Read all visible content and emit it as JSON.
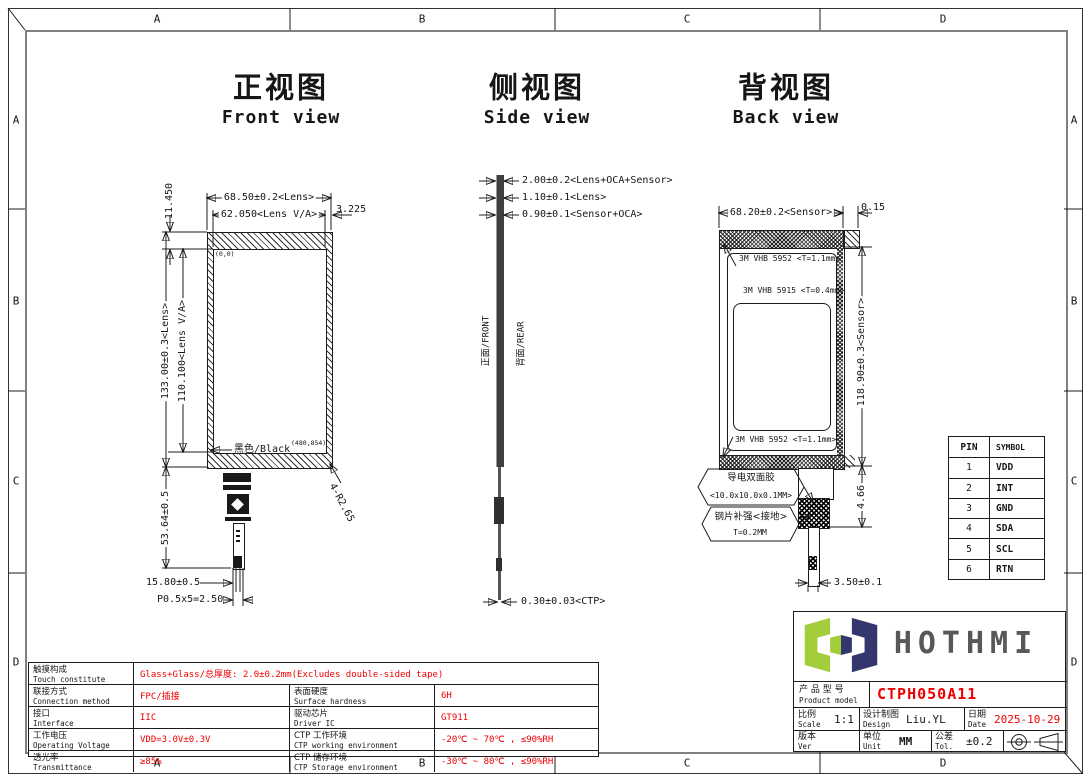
{
  "border": {
    "cols": [
      "A",
      "B",
      "C",
      "D"
    ],
    "rows": [
      "A",
      "B",
      "C",
      "D"
    ]
  },
  "views": {
    "front": {
      "title_cn": "正视图",
      "title_en": "Front view",
      "dim_lens_w": "68.50±0.2<Lens>",
      "dim_va_w": "62.050<Lens V/A>",
      "dim_side_margin": "3.225",
      "dim_top_margin": "11.450",
      "dim_lens_h": "133.00±0.3<Lens>",
      "dim_va_h": "110.100<Lens V/A>",
      "label_black": "黑色/Black",
      "label_origin": "(0,0)",
      "label_resolution": "(480,854)",
      "dim_corner_radius": "4-R2.65",
      "dim_fpc_length": "53.64±0.5",
      "dim_fpc_offset": "15.80±0.5",
      "dim_fpc_pitch": "P0.5x5=2.50"
    },
    "side": {
      "title_cn": "侧视图",
      "title_en": "Side view",
      "dim_total": "2.00±0.2<Lens+OCA+Sensor>",
      "dim_lens": "1.10±0.1<Lens>",
      "dim_sensor_oca": "0.90±0.1<Sensor+OCA>",
      "label_front_face": "正面/FRONT",
      "label_rear_face": "背面/REAR",
      "dim_ctp": "0.30±0.03<CTP>"
    },
    "back": {
      "title_cn": "背视图",
      "title_en": "Back view",
      "dim_sensor_w": "68.20±0.2<Sensor>",
      "dim_edge_offset": "0.15",
      "tape_top": "3M VHB 5952 <T=1.1mm>",
      "tape_inner": "3M VHB 5915 <T=0.4mm>",
      "tape_bottom": "3M VHB 5952 <T=1.1mm>",
      "dim_sensor_h": "118.90±0.3<Sensor>",
      "label_cond_tape": "导电双面胶",
      "label_cond_tape_size": "<10.0x10.0x0.1MM>",
      "label_steel": "钢片补强<接地>",
      "label_steel_thickness": "T=0.2MM",
      "dim_tail_gap": "4.66",
      "dim_fpc_width": "3.50±0.1"
    }
  },
  "pin_table": {
    "headers": [
      "PIN",
      "SYMBOL"
    ],
    "rows": [
      [
        "1",
        "VDD"
      ],
      [
        "2",
        "INT"
      ],
      [
        "3",
        "GND"
      ],
      [
        "4",
        "SDA"
      ],
      [
        "5",
        "SCL"
      ],
      [
        "6",
        "RTN"
      ]
    ]
  },
  "spec_table": {
    "rows": [
      {
        "c1_cn": "触摸构成",
        "c1_en": "Touch constitute",
        "v1": "Glass+Glass/总厚度: 2.0±0.2mm(Excludes double-sided tape)"
      },
      {
        "c1_cn": "联接方式",
        "c1_en": "Connection method",
        "v1": "FPC/插接",
        "c2_cn": "表面硬度",
        "c2_en": "Surface hardness",
        "v2": "6H"
      },
      {
        "c1_cn": "接口",
        "c1_en": "Interface",
        "v1": "IIC",
        "c2_cn": "驱动芯片",
        "c2_en": "Driver IC",
        "v2": "GT911"
      },
      {
        "c1_cn": "工作电压",
        "c1_en": "Operating Voltage",
        "v1": "VDD=3.0V±0.3V",
        "c2_cn": "CTP 工作环境",
        "c2_en": "CTP working environment",
        "v2": "-20℃ ~ 70℃ , ≤90%RH"
      },
      {
        "c1_cn": "透光率",
        "c1_en": "Transmittance",
        "v1": "≥85%",
        "c2_cn": "CTP 储存环境",
        "c2_en": "CTP Storage environment",
        "v2": "-30℃ ~ 80℃ , ≤90%RH"
      }
    ]
  },
  "title_block": {
    "logo_text": "HOTHMI",
    "product_label_cn": "产 品 型 号",
    "product_label_en": "Product model",
    "product_model": "CTPH050A11",
    "scale_cn": "比例",
    "scale_en": "Scale",
    "scale": "1:1",
    "design_cn": "设计制图",
    "design_en": "Design",
    "design": "Liu.YL",
    "date_cn": "日期",
    "date_en": "Date",
    "date": "2025-10-29",
    "ver_cn": "版本",
    "ver_en": "Ver",
    "ver": "V0-0",
    "unit_cn": "单位",
    "unit_en": "Unit",
    "unit": "MM",
    "tol_cn": "公差",
    "tol_en": "Tol.",
    "tol": "±0.2"
  },
  "colors": {
    "value_red": "#f00000",
    "line": "#1c1c1c",
    "inner_border_gray": "#808080",
    "logo_green": "#a3cd3a",
    "logo_navy": "#34376e",
    "logo_text_gray": "#57585a"
  }
}
